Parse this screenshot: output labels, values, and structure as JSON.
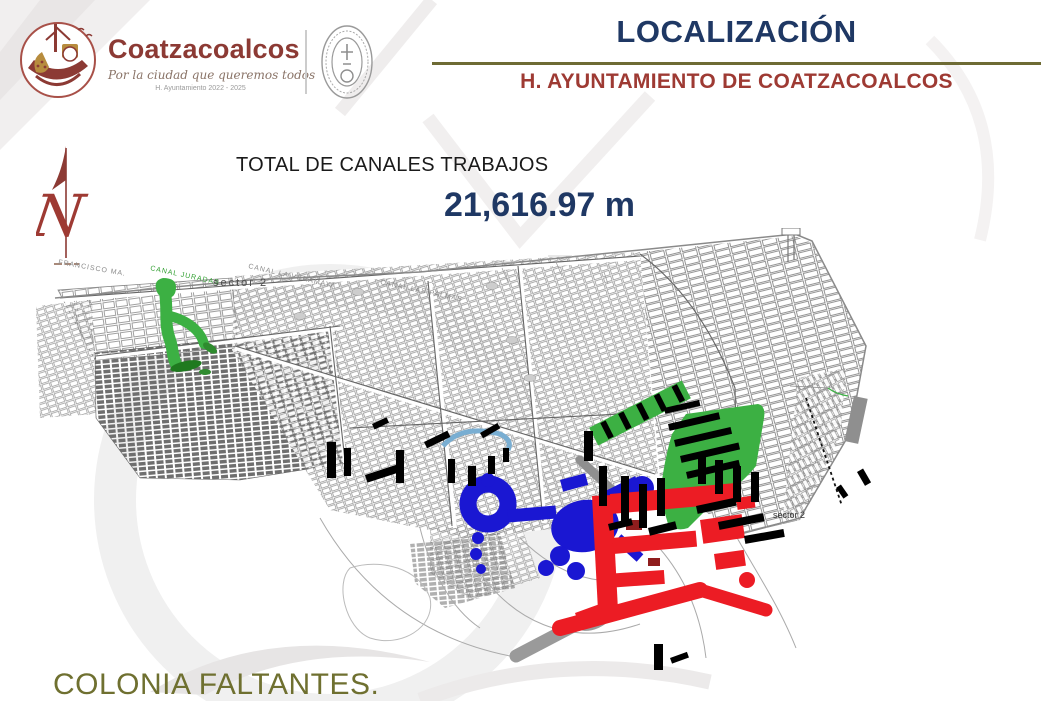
{
  "brand": {
    "name": "Coatzacoalcos",
    "tagline": "Por la ciudad que queremos todos",
    "administration": "H. Ayuntamiento 2022 - 2025"
  },
  "header": {
    "title": "LOCALIZACIÓN",
    "subtitle": "H. AYUNTAMIENTO DE COATZACOALCOS"
  },
  "stats": {
    "label": "TOTAL DE CANALES TRABAJOS",
    "value": "21,616.97 m"
  },
  "map": {
    "north_letter": "N",
    "labels": {
      "street_francisco": "FRANCISCO MA.",
      "canal_juradas": "CANAL JURADAS",
      "sector_left": "sector 2",
      "canal_veramaya": "CANAL LA VERAMAYA",
      "canal_palmas": "CANAL LAS PALMAS",
      "sector_right": "sector 2"
    },
    "colors": {
      "worked_green": "#3cb043",
      "worked_blue": "#1a17d2",
      "worked_red": "#ec1c24",
      "highlight_black": "#000000",
      "base_gray": "#7a7a7a"
    }
  },
  "footer": {
    "note": "COLONIA FALTANTES."
  },
  "theme": {
    "navy": "#1f3864",
    "brick": "#9e3a33",
    "olive": "#6e6b34",
    "maroon": "#8c3a34",
    "footer_olive": "#6f7030"
  }
}
